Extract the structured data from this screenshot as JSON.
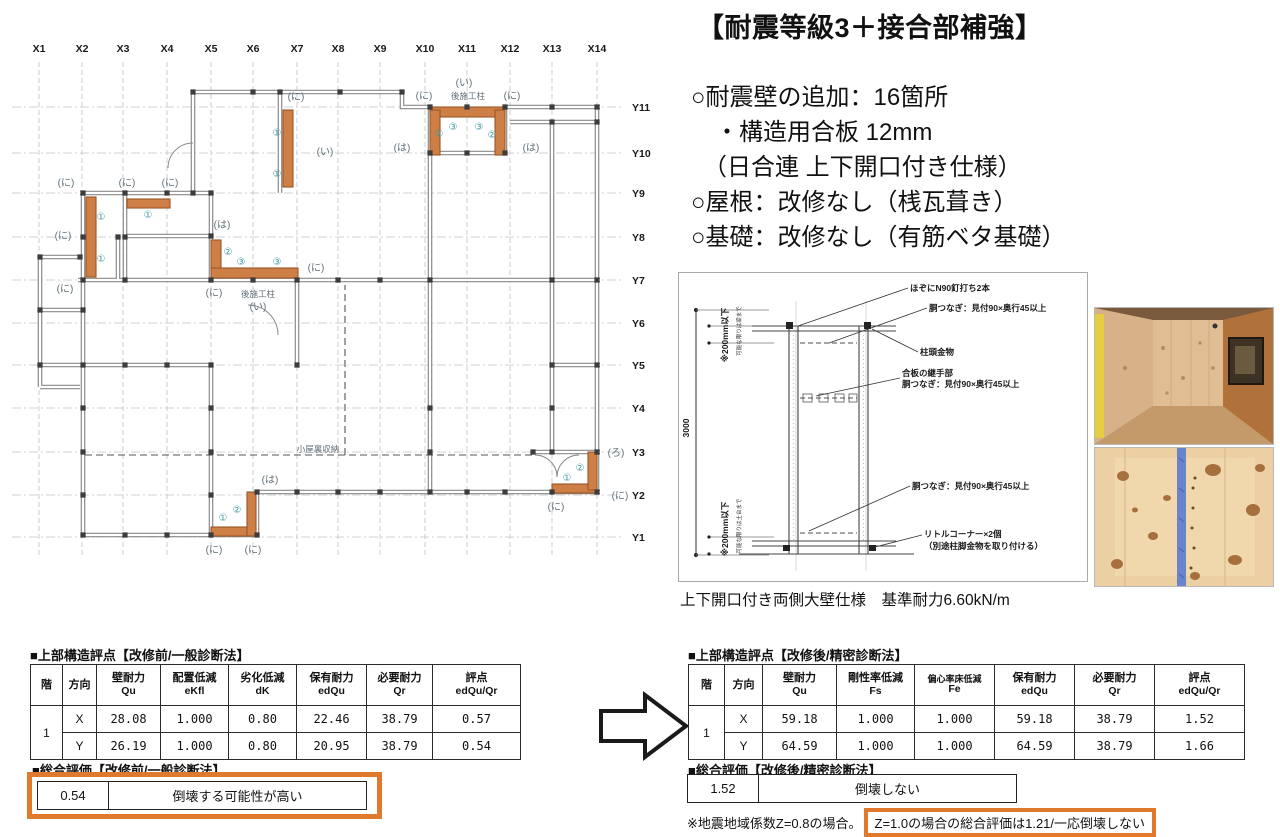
{
  "title": "【耐震等級3＋接合部補強】",
  "bullets": [
    "○耐震壁の追加：16箇所",
    "　・構造用合板 12mm",
    "　（日合連 上下開口付き仕様）",
    "○屋根：改修なし（桟瓦葺き）",
    "○基礎：改修なし（有筋ベタ基礎）"
  ],
  "floor_plan": {
    "x_labels": [
      "X1",
      "X2",
      "X3",
      "X4",
      "X5",
      "X6",
      "X7",
      "X8",
      "X9",
      "X10",
      "X11",
      "X12",
      "X13",
      "X14"
    ],
    "x_cols": [
      39,
      82,
      123,
      167,
      211,
      253,
      297,
      338,
      380,
      425,
      467,
      510,
      552,
      597
    ],
    "y_labels": [
      "Y11",
      "Y10",
      "Y9",
      "Y8",
      "Y7",
      "Y6",
      "Y5",
      "Y4",
      "Y3",
      "Y2",
      "Y1"
    ],
    "y_rows": [
      107,
      153,
      193,
      237,
      280,
      323,
      365,
      408,
      452,
      495,
      537
    ],
    "reinforced_wall_color": "#cd7f45",
    "wall_labels": [
      {
        "t": "(に)",
        "x": 66,
        "y": 186
      },
      {
        "t": "(に)",
        "x": 127,
        "y": 186
      },
      {
        "t": "(に)",
        "x": 170,
        "y": 186
      },
      {
        "t": "(に)",
        "x": 296,
        "y": 100
      },
      {
        "t": "(い)",
        "x": 325,
        "y": 155
      },
      {
        "t": "(は)",
        "x": 222,
        "y": 228
      },
      {
        "t": "(に)",
        "x": 63,
        "y": 239
      },
      {
        "t": "(に)",
        "x": 65,
        "y": 292
      },
      {
        "t": "(に)",
        "x": 316,
        "y": 271
      },
      {
        "t": "(に)",
        "x": 214,
        "y": 296
      },
      {
        "t": "後施工柱",
        "x": 258,
        "y": 297,
        "small": true
      },
      {
        "t": "(い)",
        "x": 258,
        "y": 310
      },
      {
        "t": "(い)",
        "x": 464,
        "y": 86
      },
      {
        "t": "後施工柱",
        "x": 468,
        "y": 99,
        "small": true
      },
      {
        "t": "(に)",
        "x": 424,
        "y": 99
      },
      {
        "t": "(に)",
        "x": 512,
        "y": 99
      },
      {
        "t": "(は)",
        "x": 402,
        "y": 151
      },
      {
        "t": "(は)",
        "x": 531,
        "y": 151
      },
      {
        "t": "小屋裏収納",
        "x": 318,
        "y": 452,
        "small": true
      },
      {
        "t": "(は)",
        "x": 270,
        "y": 483
      },
      {
        "t": "(に)",
        "x": 214,
        "y": 553
      },
      {
        "t": "(に)",
        "x": 253,
        "y": 553
      },
      {
        "t": "(ろ)",
        "x": 616,
        "y": 456
      },
      {
        "t": "(に)",
        "x": 620,
        "y": 499
      },
      {
        "t": "(に)",
        "x": 556,
        "y": 510
      }
    ],
    "circled_numbers": [
      {
        "t": "①",
        "x": 101,
        "y": 220
      },
      {
        "t": "①",
        "x": 101,
        "y": 262
      },
      {
        "t": "①",
        "x": 148,
        "y": 218
      },
      {
        "t": "①",
        "x": 277,
        "y": 136
      },
      {
        "t": "①",
        "x": 277,
        "y": 177
      },
      {
        "t": "②",
        "x": 228,
        "y": 255
      },
      {
        "t": "③",
        "x": 241,
        "y": 265
      },
      {
        "t": "③",
        "x": 277,
        "y": 265
      },
      {
        "t": "②",
        "x": 439,
        "y": 137
      },
      {
        "t": "③",
        "x": 453,
        "y": 130
      },
      {
        "t": "③",
        "x": 479,
        "y": 130
      },
      {
        "t": "②",
        "x": 492,
        "y": 138
      },
      {
        "t": "①",
        "x": 223,
        "y": 521
      },
      {
        "t": "②",
        "x": 237,
        "y": 513
      },
      {
        "t": "①",
        "x": 567,
        "y": 481
      },
      {
        "t": "②",
        "x": 580,
        "y": 471
      }
    ]
  },
  "detail_diagram": {
    "ann_hozo": "ほぞにN90釘打ち2本",
    "ann_dotsunagi_top": "胴つなぎ：見付90×奥行45以上",
    "ann_chutou": "柱頭金物",
    "ann_gouhan1": "合板の継手部",
    "ann_gouhan2": "胴つなぎ：見付90×奥行45以上",
    "ann_dotsunagi_low": "胴つなぎ：見付90×奥行45以上",
    "ann_little1": "リトルコーナー×2個",
    "ann_little2": "（別途柱脚金物を取り付ける）",
    "dim_3000": "3000",
    "dim_200_top": "※200mm以下",
    "note_top": "可能な限りは梁まで",
    "dim_200_bottom": "※200mm以下",
    "note_bottom": "可能な限りは土台まで",
    "caption": "上下開口付き両側大壁仕様　基準耐力6.60kN/m"
  },
  "tables": {
    "before": {
      "title": "■上部構造評点【改修前/一般診断法】",
      "headers": [
        {
          "l1": "階",
          "l2": ""
        },
        {
          "l1": "方向",
          "l2": ""
        },
        {
          "l1": "壁耐力",
          "l2": "Qu"
        },
        {
          "l1": "配置低減",
          "l2": "eKfl"
        },
        {
          "l1": "劣化低減",
          "l2": "dK"
        },
        {
          "l1": "保有耐力",
          "l2": "edQu"
        },
        {
          "l1": "必要耐力",
          "l2": "Qr"
        },
        {
          "l1": "評点",
          "l2": "edQu/Qr"
        }
      ],
      "rows": [
        [
          "1",
          "X",
          "28.08",
          "1.000",
          "0.80",
          "22.46",
          "38.79",
          "0.57"
        ],
        [
          "",
          "Y",
          "26.19",
          "1.000",
          "0.80",
          "20.95",
          "38.79",
          "0.54"
        ]
      ],
      "summary_title": "■総合評価【改修前/一般診断法】",
      "summary_value": "0.54",
      "summary_text": "倒壊する可能性が高い"
    },
    "after": {
      "title": "■上部構造評点【改修後/精密診断法】",
      "headers": [
        {
          "l1": "階",
          "l2": ""
        },
        {
          "l1": "方向",
          "l2": ""
        },
        {
          "l1": "壁耐力",
          "l2": "Qu"
        },
        {
          "l1": "剛性率低減",
          "l2": "Fs"
        },
        {
          "l1": "偏心率床低減",
          "l2": "Fe",
          "small": true
        },
        {
          "l1": "保有耐力",
          "l2": "edQu"
        },
        {
          "l1": "必要耐力",
          "l2": "Qr"
        },
        {
          "l1": "評点",
          "l2": "edQu/Qr"
        }
      ],
      "rows": [
        [
          "1",
          "X",
          "59.18",
          "1.000",
          "1.000",
          "59.18",
          "38.79",
          "1.52"
        ],
        [
          "",
          "Y",
          "64.59",
          "1.000",
          "1.000",
          "64.59",
          "38.79",
          "1.66"
        ]
      ],
      "summary_title": "■総合評価【改修後/精密診断法】",
      "summary_value": "1.52",
      "summary_text": "倒壊しない",
      "note_prefix": "※地震地域係数Z=0.8の場合。",
      "note_highlight": "Z=1.0の場合の総合評価は1.21/一応倒壊しない"
    }
  },
  "colors": {
    "highlight_orange": "#e0792c",
    "reinforced_wall": "#cd7f45",
    "circled_number_teal": "#3f98a0"
  }
}
